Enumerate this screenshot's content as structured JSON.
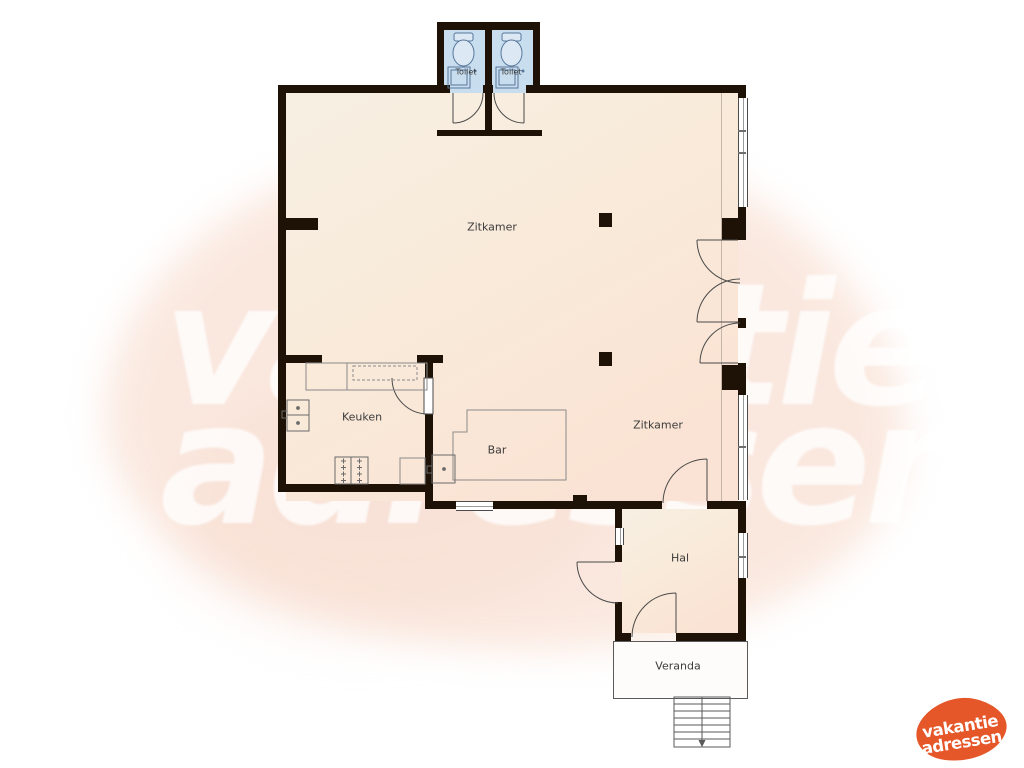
{
  "watermark": {
    "line1": "vakantie",
    "line2": "adressen"
  },
  "logo": {
    "line1": "vakantie",
    "line2": "adressen",
    "color": "#e55628"
  },
  "rooms": {
    "toilet_left": {
      "label": "Toilet"
    },
    "toilet_right": {
      "label": "Toilet"
    },
    "zitkamer_main": {
      "label": "Zitkamer"
    },
    "keuken": {
      "label": "Keuken"
    },
    "bar": {
      "label": "Bar"
    },
    "zitkamer_second": {
      "label": "Zitkamer"
    },
    "hal": {
      "label": "Hal"
    },
    "veranda": {
      "label": "Veranda"
    }
  },
  "colors": {
    "wall": "#1e1105",
    "floor_main": "#f9ead9",
    "floor_toilet": "#c8ddee",
    "accent_orange": "#e55628",
    "background_blob": "#fae5da"
  }
}
